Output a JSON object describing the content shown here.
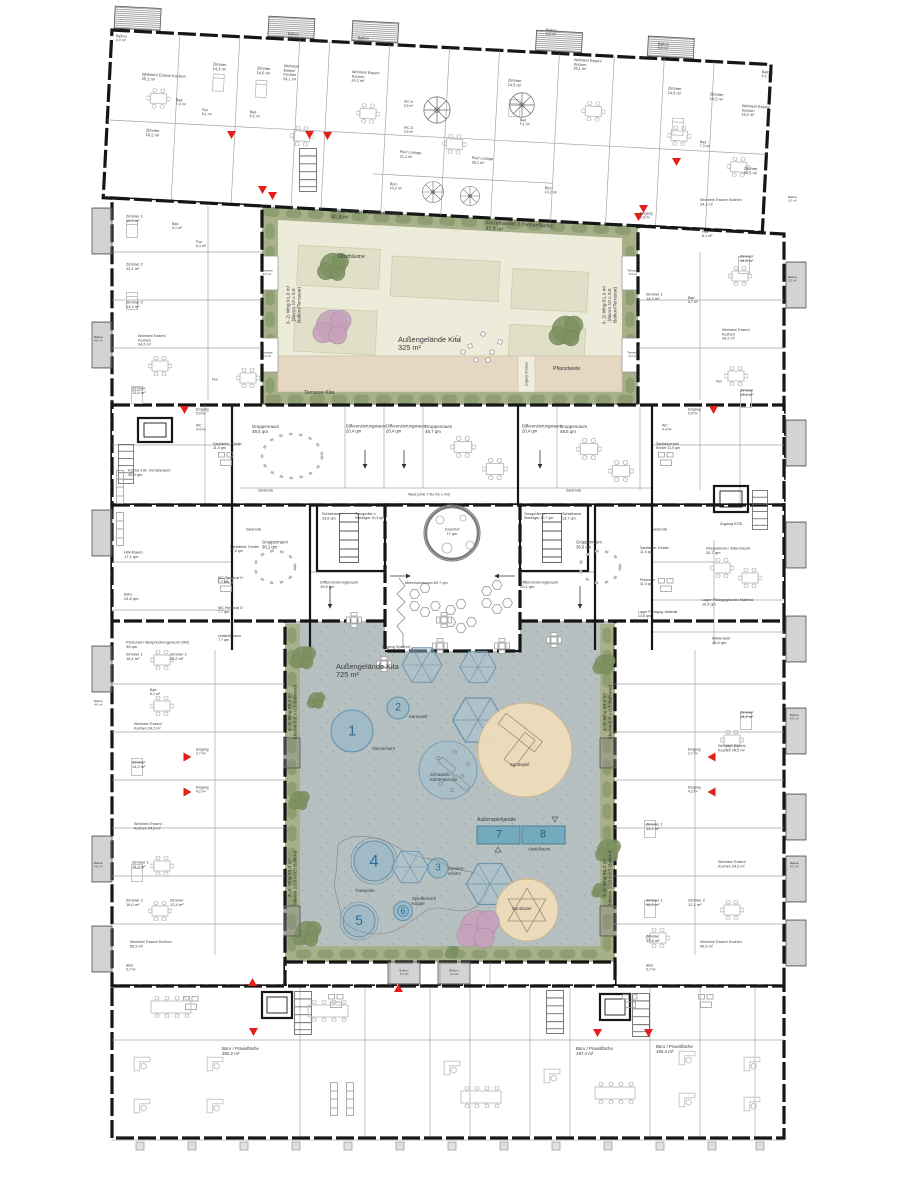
{
  "document": {
    "type": "architectural-floor-plan",
    "building": "Wohn- und Kitagebäude mit Büro/Praxisflächen"
  },
  "colors": {
    "wall": "#161616",
    "partition": "#8f8f8f",
    "furniture": "#bdbdbd",
    "green_strip": "#a7b089",
    "hedge": "#8b9a6e",
    "court_upper": "#edebda",
    "planting_bed": "#dfe0c7",
    "terrace_wood": "#e5d7c2",
    "court_lower": "#b7c0c1",
    "play_blue": "#8fb7ca",
    "play_blue_stroke": "#5d8fae",
    "umbrella_blue": "#a9c6d3",
    "sand": "#efddbb",
    "equipment_teal": "#74aabe",
    "entrance_red": "#e32017",
    "tree_green": "#7d9161",
    "tree_pink": "#c6a0bb",
    "number_blue": "#2d6e99"
  },
  "labels": [
    {
      "t": "Balkon\n4,0 m²",
      "x": 116,
      "y": 34,
      "fs": 3.6,
      "r": 3
    },
    {
      "t": "Wohnen/ Essen/ Kochen\n25,1 m²",
      "x": 142,
      "y": 72,
      "fs": 4,
      "r": 3
    },
    {
      "t": "Zimmer\n14,3 m²",
      "x": 213,
      "y": 62,
      "fs": 4,
      "r": 3
    },
    {
      "t": "Zimmer\n14,6 m²",
      "x": 257,
      "y": 66,
      "fs": 4,
      "r": 3
    },
    {
      "t": "Bad\n7,4 m²",
      "x": 176,
      "y": 98,
      "fs": 3.6,
      "r": 3
    },
    {
      "t": "Flur\n9,1 m²",
      "x": 202,
      "y": 108,
      "fs": 3.6,
      "r": 3
    },
    {
      "t": "Bad\n6,2 m²",
      "x": 250,
      "y": 110,
      "fs": 3.6,
      "r": 3
    },
    {
      "t": "Wohnen/\nEssen/\nKochen\n24,1 m²",
      "x": 284,
      "y": 64,
      "fs": 3.8,
      "r": 3
    },
    {
      "t": "Balkon\n6,0 m²",
      "x": 288,
      "y": 32,
      "fs": 3.6,
      "r": 3
    },
    {
      "t": "Balkon\n6,0 m²",
      "x": 358,
      "y": 36,
      "fs": 3.6,
      "r": 3
    },
    {
      "t": "Wohnen/ Essen/\nKochen\n24,3 m²",
      "x": 352,
      "y": 70,
      "fs": 3.8,
      "r": 3
    },
    {
      "t": "Zimmer\n16,2 m²",
      "x": 146,
      "y": 128,
      "fs": 4,
      "r": 3
    },
    {
      "t": "WC H\n3,6 m²",
      "x": 404,
      "y": 100,
      "fs": 3.4,
      "r": 3
    },
    {
      "t": "WC D\n3,6 m²",
      "x": 404,
      "y": 126,
      "fs": 3.4,
      "r": 3
    },
    {
      "t": "Flur/ Lounge\n21,1 m²",
      "x": 400,
      "y": 150,
      "fs": 3.8,
      "r": 3
    },
    {
      "t": "Flur/ Lounge\n26,1 m²",
      "x": 472,
      "y": 156,
      "fs": 3.8,
      "r": 3
    },
    {
      "t": "Büro\n10,2 m²",
      "x": 390,
      "y": 182,
      "fs": 3.6,
      "r": 3
    },
    {
      "t": "Büro\n10,2 m²",
      "x": 545,
      "y": 186,
      "fs": 3.6,
      "r": 3
    },
    {
      "t": "Bad\n5,1 m²",
      "x": 520,
      "y": 118,
      "fs": 3.6,
      "r": 3
    },
    {
      "t": "Zimmer\n14,5 m²",
      "x": 508,
      "y": 78,
      "fs": 4,
      "r": 3
    },
    {
      "t": "Wohnen/ Essen/\nKochen\n26,1 m²",
      "x": 574,
      "y": 58,
      "fs": 3.8,
      "r": 3
    },
    {
      "t": "Balkon\n6,0 m²",
      "x": 546,
      "y": 28,
      "fs": 3.6,
      "r": 3
    },
    {
      "t": "Balkon\n6,0 m²",
      "x": 658,
      "y": 42,
      "fs": 3.6,
      "r": 3
    },
    {
      "t": "Zimmer\n14,6 m²",
      "x": 668,
      "y": 86,
      "fs": 4,
      "r": 3
    },
    {
      "t": "Zimmer\n14,2 m²",
      "x": 710,
      "y": 92,
      "fs": 4,
      "r": 3
    },
    {
      "t": "Wohnen/ Essen/\nKochen\n16,2 m²",
      "x": 742,
      "y": 104,
      "fs": 3.8,
      "r": 3
    },
    {
      "t": "Bad\n7,3 m²",
      "x": 700,
      "y": 140,
      "fs": 3.6,
      "r": 3
    },
    {
      "t": "Balkon\n6,2 m²",
      "x": 762,
      "y": 70,
      "fs": 3.6,
      "r": 3
    },
    {
      "t": "Zimmer\n14,5 m²",
      "x": 744,
      "y": 166,
      "fs": 4,
      "r": 3
    },
    {
      "t": "Wohnen/ Essen/ Kochen\n24,1 m²",
      "x": 700,
      "y": 198,
      "fs": 3.8
    },
    {
      "t": "Flur\n8,1 m²",
      "x": 702,
      "y": 230,
      "fs": 3.6
    },
    {
      "t": "Balkon\n6,2 m²",
      "x": 788,
      "y": 196,
      "fs": 3
    },
    {
      "t": "Eingang\n2,9 m²",
      "x": 640,
      "y": 212,
      "fs": 3.4
    },
    {
      "t": "Einzelhandel 1 (Nebenfläche)\n81,8 m²",
      "x": 332,
      "y": 208,
      "fs": 5.2,
      "r": 3
    },
    {
      "t": "Einzelhandel 2 (Nebenfläche)\n81,8 m²",
      "x": 486,
      "y": 220,
      "fs": 5.2,
      "r": 3
    },
    {
      "t": "Obstbäume",
      "x": 338,
      "y": 254,
      "fs": 5.2
    },
    {
      "t": "Außengelände Kita\n325 m²",
      "x": 398,
      "y": 336,
      "fs": 7.4,
      "n": "upper-courtyard-title"
    },
    {
      "t": "Pflanzbeete",
      "x": 553,
      "y": 366,
      "fs": 5.2
    },
    {
      "t": "Terrasse Kita",
      "x": 304,
      "y": 390,
      "fs": 5.2
    },
    {
      "t": "Zugang Terrasse",
      "x": 527,
      "y": 374,
      "fs": 3.2,
      "r": -90,
      "a": "c"
    },
    {
      "t": "Terrasse\n6,0 m²",
      "x": 267,
      "y": 273,
      "fs": 3,
      "a": "c"
    },
    {
      "t": "Terrasse\n6,2 m²",
      "x": 267,
      "y": 355,
      "fs": 3,
      "a": "c"
    },
    {
      "t": "Terrasse\n6,0 m²",
      "x": 633,
      "y": 273,
      "fs": 3,
      "a": "c"
    },
    {
      "t": "Terrasse\n6,2 m²",
      "x": 633,
      "y": 355,
      "fs": 3,
      "a": "c"
    },
    {
      "t": "3- Zi Whg  91,3 m²\n(davon 10 x 0,5\nBalkon/Terrasse)",
      "x": 294,
      "y": 305,
      "fs": 4.8,
      "r": -90,
      "a": "c"
    },
    {
      "t": "3- Zi Whg  91,3 m²\n(davon 10 x 0,5\nBalkon/Terrasse)",
      "x": 610,
      "y": 305,
      "fs": 4.8,
      "r": -90,
      "a": "c"
    },
    {
      "t": "Zimmer 1\n16,2 m²",
      "x": 126,
      "y": 214,
      "fs": 4
    },
    {
      "t": "Bad\n5,1 m²",
      "x": 172,
      "y": 222,
      "fs": 3.6
    },
    {
      "t": "Flur\n8,1 m²",
      "x": 196,
      "y": 240,
      "fs": 3.6
    },
    {
      "t": "Zimmer 2\n12,1 m²",
      "x": 126,
      "y": 262,
      "fs": 4
    },
    {
      "t": "Zimmer 2\n14,2 m²",
      "x": 126,
      "y": 300,
      "fs": 4
    },
    {
      "t": "Wohnen/ Essen/\nKochen\n34,2 m²",
      "x": 138,
      "y": 334,
      "fs": 3.8
    },
    {
      "t": "Zimmer\n13,4 m²",
      "x": 132,
      "y": 386,
      "fs": 4
    },
    {
      "t": "Flur",
      "x": 212,
      "y": 378,
      "fs": 3.4
    },
    {
      "t": "Eingang\n5,9 m²",
      "x": 196,
      "y": 408,
      "fs": 3.4
    },
    {
      "t": "Balkon\n4,6 m²",
      "x": 94,
      "y": 336,
      "fs": 3
    },
    {
      "t": "Zimmer\n14,3 m²",
      "x": 740,
      "y": 254,
      "fs": 4
    },
    {
      "t": "Balkon\n5,2 m²",
      "x": 788,
      "y": 276,
      "fs": 3
    },
    {
      "t": "Zimmer 1\n14,2 m²",
      "x": 646,
      "y": 292,
      "fs": 4
    },
    {
      "t": "Bad\n5,7 m²",
      "x": 688,
      "y": 296,
      "fs": 3.6
    },
    {
      "t": "Wohnen/ Essen/\nKochen\n34,2 m²",
      "x": 722,
      "y": 328,
      "fs": 3.8
    },
    {
      "t": "Zimmer\n13,4 m²",
      "x": 740,
      "y": 388,
      "fs": 4
    },
    {
      "t": "Flur",
      "x": 716,
      "y": 380,
      "fs": 3.4
    },
    {
      "t": "Eingang\n5,9 m²",
      "x": 688,
      "y": 408,
      "fs": 3.4
    },
    {
      "t": "Gruppenraum\n48,5 qm",
      "x": 252,
      "y": 424,
      "fs": 4.4
    },
    {
      "t": "Differenzierungsraum\n20,4 qm",
      "x": 346,
      "y": 424,
      "fs": 4.2
    },
    {
      "t": "Differenzierungsraum\n20,4 qm",
      "x": 386,
      "y": 424,
      "fs": 4.2
    },
    {
      "t": "Gruppenraum\n48,7 qm",
      "x": 425,
      "y": 424,
      "fs": 4.4
    },
    {
      "t": "Differenzierungsraum\n20,4 qm",
      "x": 522,
      "y": 424,
      "fs": 4.2
    },
    {
      "t": "Gruppenraum\n48,5 qm",
      "x": 560,
      "y": 424,
      "fs": 4.4
    },
    {
      "t": "Sanitärber. Kinder\n11,9 qm",
      "x": 213,
      "y": 442,
      "fs": 3.6
    },
    {
      "t": "Sanitärbereich\nKinder 11,9 qm",
      "x": 656,
      "y": 442,
      "fs": 3.6
    },
    {
      "t": "WC\n4,4 m²",
      "x": 196,
      "y": 424,
      "fs": 3.4
    },
    {
      "t": "WC\n4,4 m²",
      "x": 662,
      "y": 424,
      "fs": 3.4
    },
    {
      "t": "Garderobe",
      "x": 258,
      "y": 489,
      "fs": 3.2
    },
    {
      "t": "Garderobe",
      "x": 566,
      "y": 489,
      "fs": 3.2
    },
    {
      "t": "Wand (ohne T+Da OG u. KG)",
      "x": 408,
      "y": 493,
      "fs": 3.2
    },
    {
      "t": "Küche inkl. Vorratsraum\n45,9 qm",
      "x": 128,
      "y": 468,
      "fs": 4
    },
    {
      "t": "HW-Raum\n17,1 qm",
      "x": 124,
      "y": 550,
      "fs": 4
    },
    {
      "t": "Büro\n24,8 qm",
      "x": 124,
      "y": 592,
      "fs": 4
    },
    {
      "t": "Personal-/ Besprechungsraum (R6)\n49 qm",
      "x": 126,
      "y": 640,
      "fs": 4
    },
    {
      "t": "Sanitärber. Kinder\n11,5 qm",
      "x": 230,
      "y": 545,
      "fs": 3.6
    },
    {
      "t": "WC Personal H\n7,7 qm",
      "x": 218,
      "y": 576,
      "fs": 3.6
    },
    {
      "t": "WC Personal D\n7,7 qm",
      "x": 218,
      "y": 606,
      "fs": 3.6
    },
    {
      "t": "Umkleideraum\n7,7 qm",
      "x": 218,
      "y": 634,
      "fs": 3.6
    },
    {
      "t": "Garderobe",
      "x": 246,
      "y": 528,
      "fs": 3.2
    },
    {
      "t": "Gruppenraum\n38,1 qm",
      "x": 262,
      "y": 540,
      "fs": 4.2
    },
    {
      "t": "Schlafraum\n13,6 qm",
      "x": 322,
      "y": 512,
      "fs": 3.8
    },
    {
      "t": "Turngeräte u.\nStaulager 10,3 qm",
      "x": 355,
      "y": 512,
      "fs": 3.6
    },
    {
      "t": "Differenzierungsraum\n19,5 qm",
      "x": 320,
      "y": 580,
      "fs": 4
    },
    {
      "t": "Turngeräte u.\nStaulager 10,7 qm",
      "x": 524,
      "y": 512,
      "fs": 3.6
    },
    {
      "t": "Schlafraum\n13,7 qm",
      "x": 562,
      "y": 512,
      "fs": 3.8
    },
    {
      "t": "Differenzierungsraum\n20,1 qm",
      "x": 520,
      "y": 580,
      "fs": 4
    },
    {
      "t": "Innenhof\n17 qm",
      "x": 452,
      "y": 532,
      "fs": 3.8,
      "a": "c"
    },
    {
      "t": "Mehrzweckraum 69,7 qm",
      "x": 405,
      "y": 581,
      "fs": 3.8
    },
    {
      "t": "Zugang Spielhof",
      "x": 382,
      "y": 645,
      "fs": 3.8
    },
    {
      "t": "Garderobe",
      "x": 652,
      "y": 528,
      "fs": 3.2
    },
    {
      "t": "Gruppenraum\n38,6 qm",
      "x": 576,
      "y": 540,
      "fs": 4.2
    },
    {
      "t": "Sanitärber. Kinder\n11,5 qm",
      "x": 640,
      "y": 546,
      "fs": 3.6
    },
    {
      "t": "Putzraum\n11,4 qm",
      "x": 640,
      "y": 578,
      "fs": 3.6
    },
    {
      "t": "Lager Pädagog. Material\n13,8 qm",
      "x": 638,
      "y": 610,
      "fs": 3.6
    },
    {
      "t": "Integrations-/ Elternraum\n30,7 qm",
      "x": 706,
      "y": 546,
      "fs": 4
    },
    {
      "t": "Lager Pädagogisches Material\n15,9 qm",
      "x": 702,
      "y": 598,
      "fs": 3.8
    },
    {
      "t": "Werkraum\n45,6 qm",
      "x": 712,
      "y": 636,
      "fs": 4
    },
    {
      "t": "Zugang KITA",
      "x": 720,
      "y": 522,
      "fs": 3.8
    },
    {
      "t": "Außengelände Kita\n725 m²",
      "x": 336,
      "y": 663,
      "fs": 7.4,
      "n": "lower-courtyard-title"
    },
    {
      "t": "Sitzelement",
      "x": 372,
      "y": 746,
      "fs": 4.4
    },
    {
      "t": "Karussell",
      "x": 409,
      "y": 714,
      "fs": 4.4
    },
    {
      "t": "Schaukeln +\nKletterparcour",
      "x": 430,
      "y": 772,
      "fs": 4.4
    },
    {
      "t": "Sandspiel",
      "x": 510,
      "y": 762,
      "fs": 4.4
    },
    {
      "t": "Trampolin",
      "x": 355,
      "y": 888,
      "fs": 4.4
    },
    {
      "t": "Sonnen-\nschirm",
      "x": 448,
      "y": 866,
      "fs": 4.4
    },
    {
      "t": "Spielbereich\nKrippe",
      "x": 412,
      "y": 896,
      "fs": 4.4
    },
    {
      "t": "Sandspiel",
      "x": 512,
      "y": 906,
      "fs": 4.4
    },
    {
      "t": "Außenspielgeräte",
      "x": 477,
      "y": 817,
      "fs": 5
    },
    {
      "t": "Abstellraum",
      "x": 528,
      "y": 847,
      "fs": 4.2
    },
    {
      "t": "1",
      "x": 352,
      "y": 731,
      "fs": 15,
      "c": "#2d6e99",
      "a": "c",
      "n": "play-number-1"
    },
    {
      "t": "2",
      "x": 398,
      "y": 708,
      "fs": 11,
      "c": "#2d6e99",
      "a": "c",
      "n": "play-number-2"
    },
    {
      "t": "3",
      "x": 438,
      "y": 868,
      "fs": 10,
      "c": "#2d6e99",
      "a": "c",
      "n": "play-number-3"
    },
    {
      "t": "4",
      "x": 374,
      "y": 861,
      "fs": 17,
      "c": "#2d6e99",
      "a": "c",
      "n": "play-number-4"
    },
    {
      "t": "5",
      "x": 359,
      "y": 921,
      "fs": 14,
      "c": "#2d6e99",
      "a": "c",
      "n": "play-number-5"
    },
    {
      "t": "6",
      "x": 403,
      "y": 911,
      "fs": 9,
      "c": "#2d6e99",
      "a": "c",
      "n": "play-number-6"
    },
    {
      "t": "7",
      "x": 499,
      "y": 835,
      "fs": 11,
      "c": "#1f5f80",
      "a": "c",
      "n": "play-number-7"
    },
    {
      "t": "8",
      "x": 543,
      "y": 835,
      "fs": 11,
      "c": "#1f5f80",
      "a": "c",
      "n": "play-number-8"
    },
    {
      "t": "3- Zi Whg  90,2 m²\n(davon 6,0 x 0,5 Balkone)",
      "x": 293,
      "y": 712,
      "fs": 4.8,
      "r": -90,
      "a": "c"
    },
    {
      "t": "3- Zi Whg  90,2 m²\n(davon 6,0 x 0,5 Balkone)",
      "x": 608,
      "y": 712,
      "fs": 4.8,
      "r": -90,
      "a": "c"
    },
    {
      "t": "3- Zi Whg  90,3 m²\n(davon 10,0 x 0,5 Balkon)",
      "x": 293,
      "y": 878,
      "fs": 4.8,
      "r": -90,
      "a": "c"
    },
    {
      "t": "3- Zi Whg  90,3 m²\n(davon 10,0 x 0,5 Balkon)",
      "x": 608,
      "y": 878,
      "fs": 4.8,
      "r": -90,
      "a": "c"
    },
    {
      "t": "Zimmer 1\n16,1 m²",
      "x": 126,
      "y": 652,
      "fs": 4
    },
    {
      "t": "Zimmer 2\n11,2 m²",
      "x": 170,
      "y": 652,
      "fs": 4
    },
    {
      "t": "Bad\n6,1 m²",
      "x": 150,
      "y": 688,
      "fs": 3.6
    },
    {
      "t": "Wohnen/ Essen/\nKochen 24,2 m²",
      "x": 134,
      "y": 722,
      "fs": 3.8
    },
    {
      "t": "Zimmer\n14,2 m²",
      "x": 132,
      "y": 760,
      "fs": 4
    },
    {
      "t": "Eingang\n2,7 m²",
      "x": 196,
      "y": 748,
      "fs": 3.4
    },
    {
      "t": "Eingang\n4,2 m²",
      "x": 196,
      "y": 786,
      "fs": 3.4
    },
    {
      "t": "Wohnen/ Essen/\nKochen 24,2 m²",
      "x": 134,
      "y": 822,
      "fs": 3.8
    },
    {
      "t": "Zimmer 1\n14,4 m²",
      "x": 132,
      "y": 860,
      "fs": 4
    },
    {
      "t": "Zimmer 2\n16,0 m²",
      "x": 126,
      "y": 898,
      "fs": 4
    },
    {
      "t": "Zimmer\n12,4 m²",
      "x": 170,
      "y": 898,
      "fs": 4
    },
    {
      "t": "Wohnen/ Essen/ Kochen\n56,9 m²",
      "x": 130,
      "y": 940,
      "fs": 3.8
    },
    {
      "t": "Abst.\n5,7 m²",
      "x": 126,
      "y": 964,
      "fs": 3.4
    },
    {
      "t": "Balkon\n4,6 m²",
      "x": 94,
      "y": 700,
      "fs": 3
    },
    {
      "t": "Balkon\n4,6 m²",
      "x": 94,
      "y": 862,
      "fs": 3
    },
    {
      "t": "Zimmer\n14,2 m²",
      "x": 740,
      "y": 710,
      "fs": 4
    },
    {
      "t": "Wohnen/ Essen/\nKochen 24,2 m²",
      "x": 718,
      "y": 744,
      "fs": 3.8
    },
    {
      "t": "Eingang\n2,7 m²",
      "x": 688,
      "y": 748,
      "fs": 3.4
    },
    {
      "t": "Eingang\n4,2 m²",
      "x": 688,
      "y": 786,
      "fs": 3.4
    },
    {
      "t": "Zimmer 1\n14,4 m²",
      "x": 646,
      "y": 822,
      "fs": 4
    },
    {
      "t": "Wohnen/ Essen/\nKochen 24,2 m²",
      "x": 718,
      "y": 860,
      "fs": 3.8
    },
    {
      "t": "Zimmer 1\n16,2 m²",
      "x": 646,
      "y": 898,
      "fs": 4
    },
    {
      "t": "Zimmer 2\n12,1 m²",
      "x": 688,
      "y": 898,
      "fs": 4
    },
    {
      "t": "Zimmer\n12,6 m²",
      "x": 646,
      "y": 934,
      "fs": 4
    },
    {
      "t": "Wohnen/ Essen/ Kochen\n56,9 m²",
      "x": 700,
      "y": 940,
      "fs": 3.8
    },
    {
      "t": "Abst.\n5,7 m²",
      "x": 646,
      "y": 964,
      "fs": 3.4
    },
    {
      "t": "Balkon\n6,2 m²",
      "x": 790,
      "y": 714,
      "fs": 3
    },
    {
      "t": "Balkon\n6,2 m²",
      "x": 790,
      "y": 862,
      "fs": 3
    },
    {
      "t": "Balkon\n6,2 m²",
      "x": 404,
      "y": 973,
      "fs": 3,
      "a": "c"
    },
    {
      "t": "Balkon\n6,2 m²",
      "x": 454,
      "y": 973,
      "fs": 3,
      "a": "c"
    },
    {
      "t": "Büro / Praxisfläche\n382,2 m²",
      "x": 222,
      "y": 1046,
      "fs": 4.4
    },
    {
      "t": "Büro / Praxisfläche\n187,4 m²",
      "x": 576,
      "y": 1046,
      "fs": 4.4
    },
    {
      "t": "Büro / Praxisfläche\n150,4 m²",
      "x": 656,
      "y": 1044,
      "fs": 4.4
    }
  ]
}
